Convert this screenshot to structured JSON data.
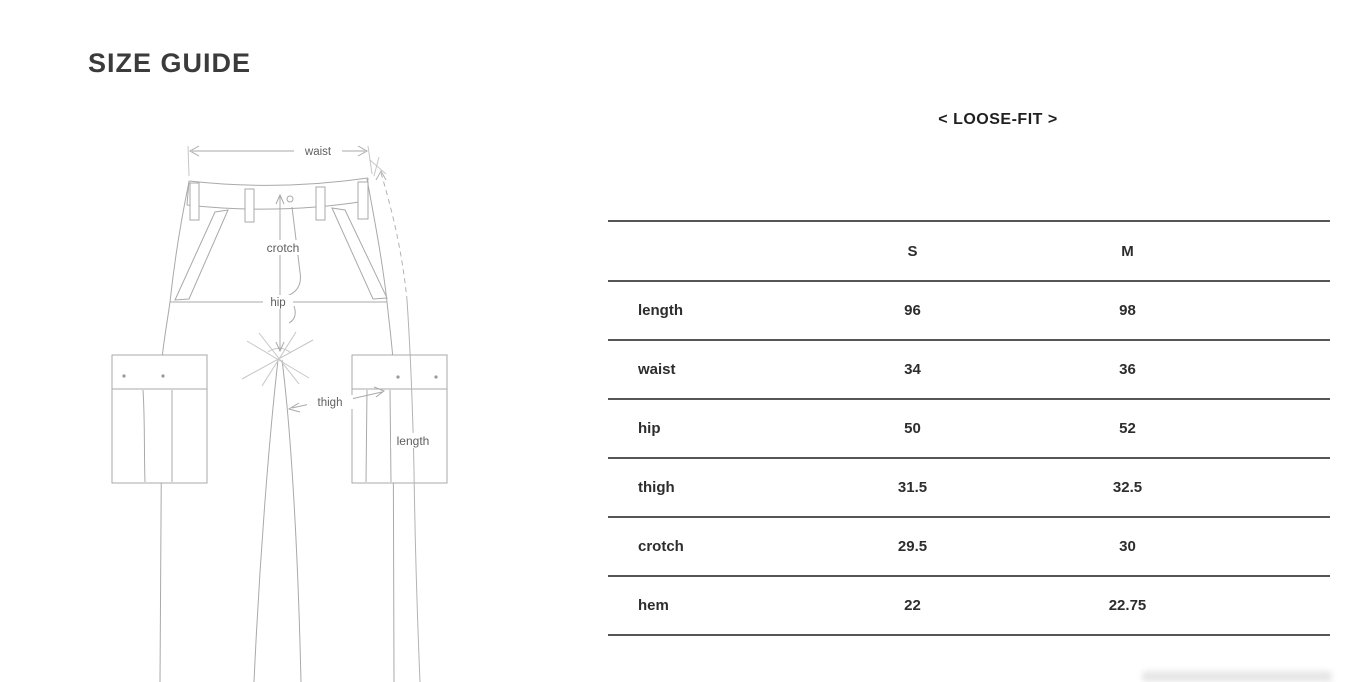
{
  "page": {
    "title": "SIZE GUIDE"
  },
  "diagram": {
    "labels": {
      "waist": "waist",
      "crotch": "crotch",
      "hip": "hip",
      "thigh": "thigh",
      "length": "length"
    }
  },
  "size_table": {
    "fit_label": "< LOOSE-FIT >",
    "columns": [
      "S",
      "M"
    ],
    "rows": [
      {
        "label": "length",
        "s": "96",
        "m": "98"
      },
      {
        "label": "waist",
        "s": "34",
        "m": "36"
      },
      {
        "label": "hip",
        "s": "50",
        "m": "52"
      },
      {
        "label": "thigh",
        "s": "31.5",
        "m": "32.5"
      },
      {
        "label": "crotch",
        "s": "29.5",
        "m": "30"
      },
      {
        "label": "hem",
        "s": "22",
        "m": "22.75"
      }
    ]
  },
  "colors": {
    "heading_text": "#3b3b3b",
    "table_text": "#2d2d2d",
    "table_rule": "#565656",
    "diagram_line": "#a9a9a9",
    "diagram_label": "#5f5f5f"
  }
}
